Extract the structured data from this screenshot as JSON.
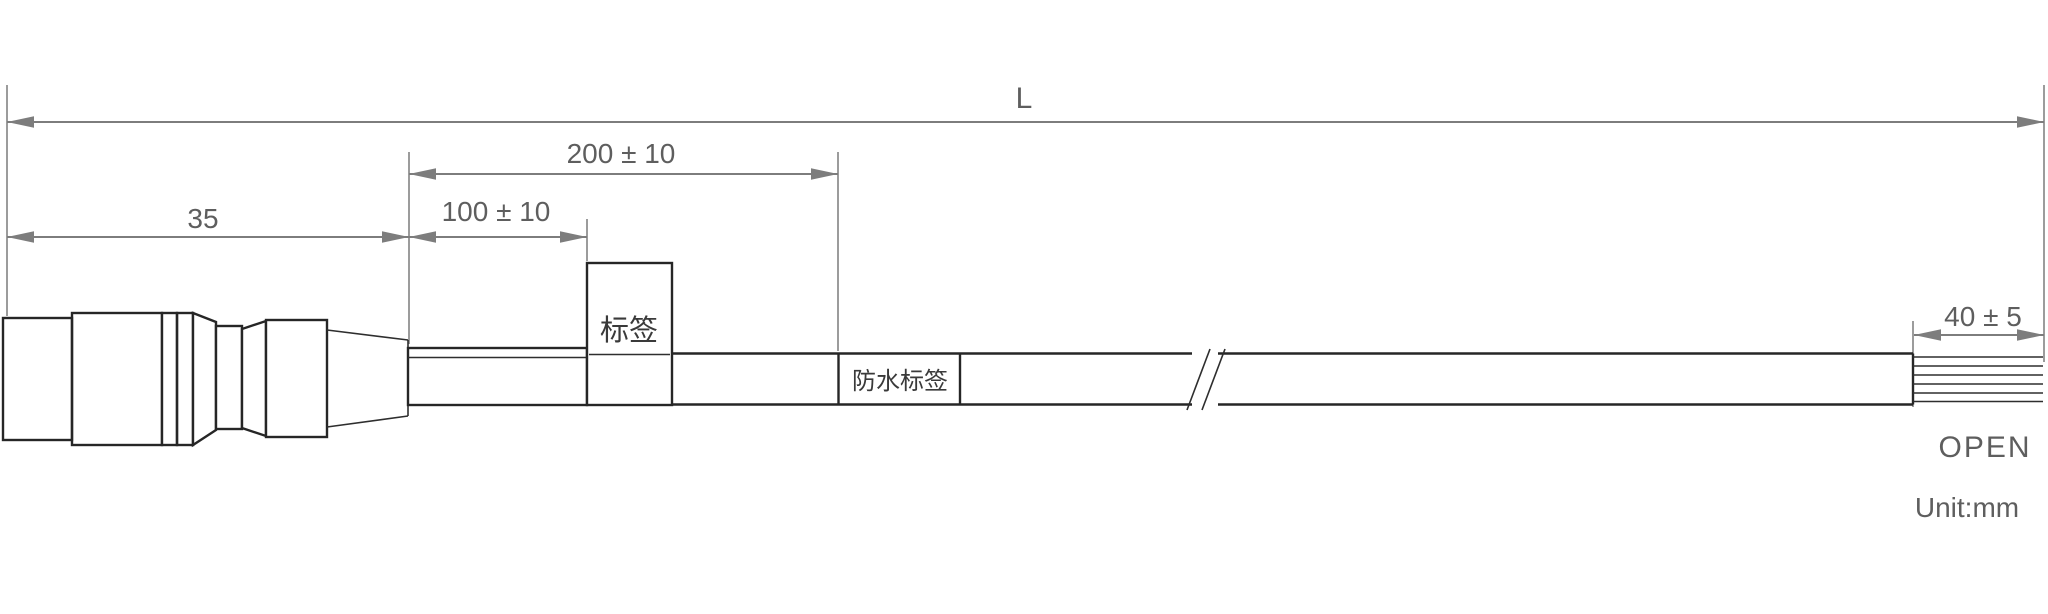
{
  "drawing": {
    "unit_note": "Unit:mm",
    "dimensions": {
      "overall_length": "L",
      "tube_section": "200 ± 10",
      "label_position": "100 ± 10",
      "connector_length": "35",
      "strip_length": "40 ± 5"
    },
    "labels": {
      "cable_label": "标签",
      "waterproof_label": "防水标签",
      "wire_end": "OPEN"
    },
    "colors": {
      "background": "#ffffff",
      "outline": "#262626",
      "dimension_line": "#7d7d7d",
      "dimension_text": "#5e5e5e"
    }
  }
}
